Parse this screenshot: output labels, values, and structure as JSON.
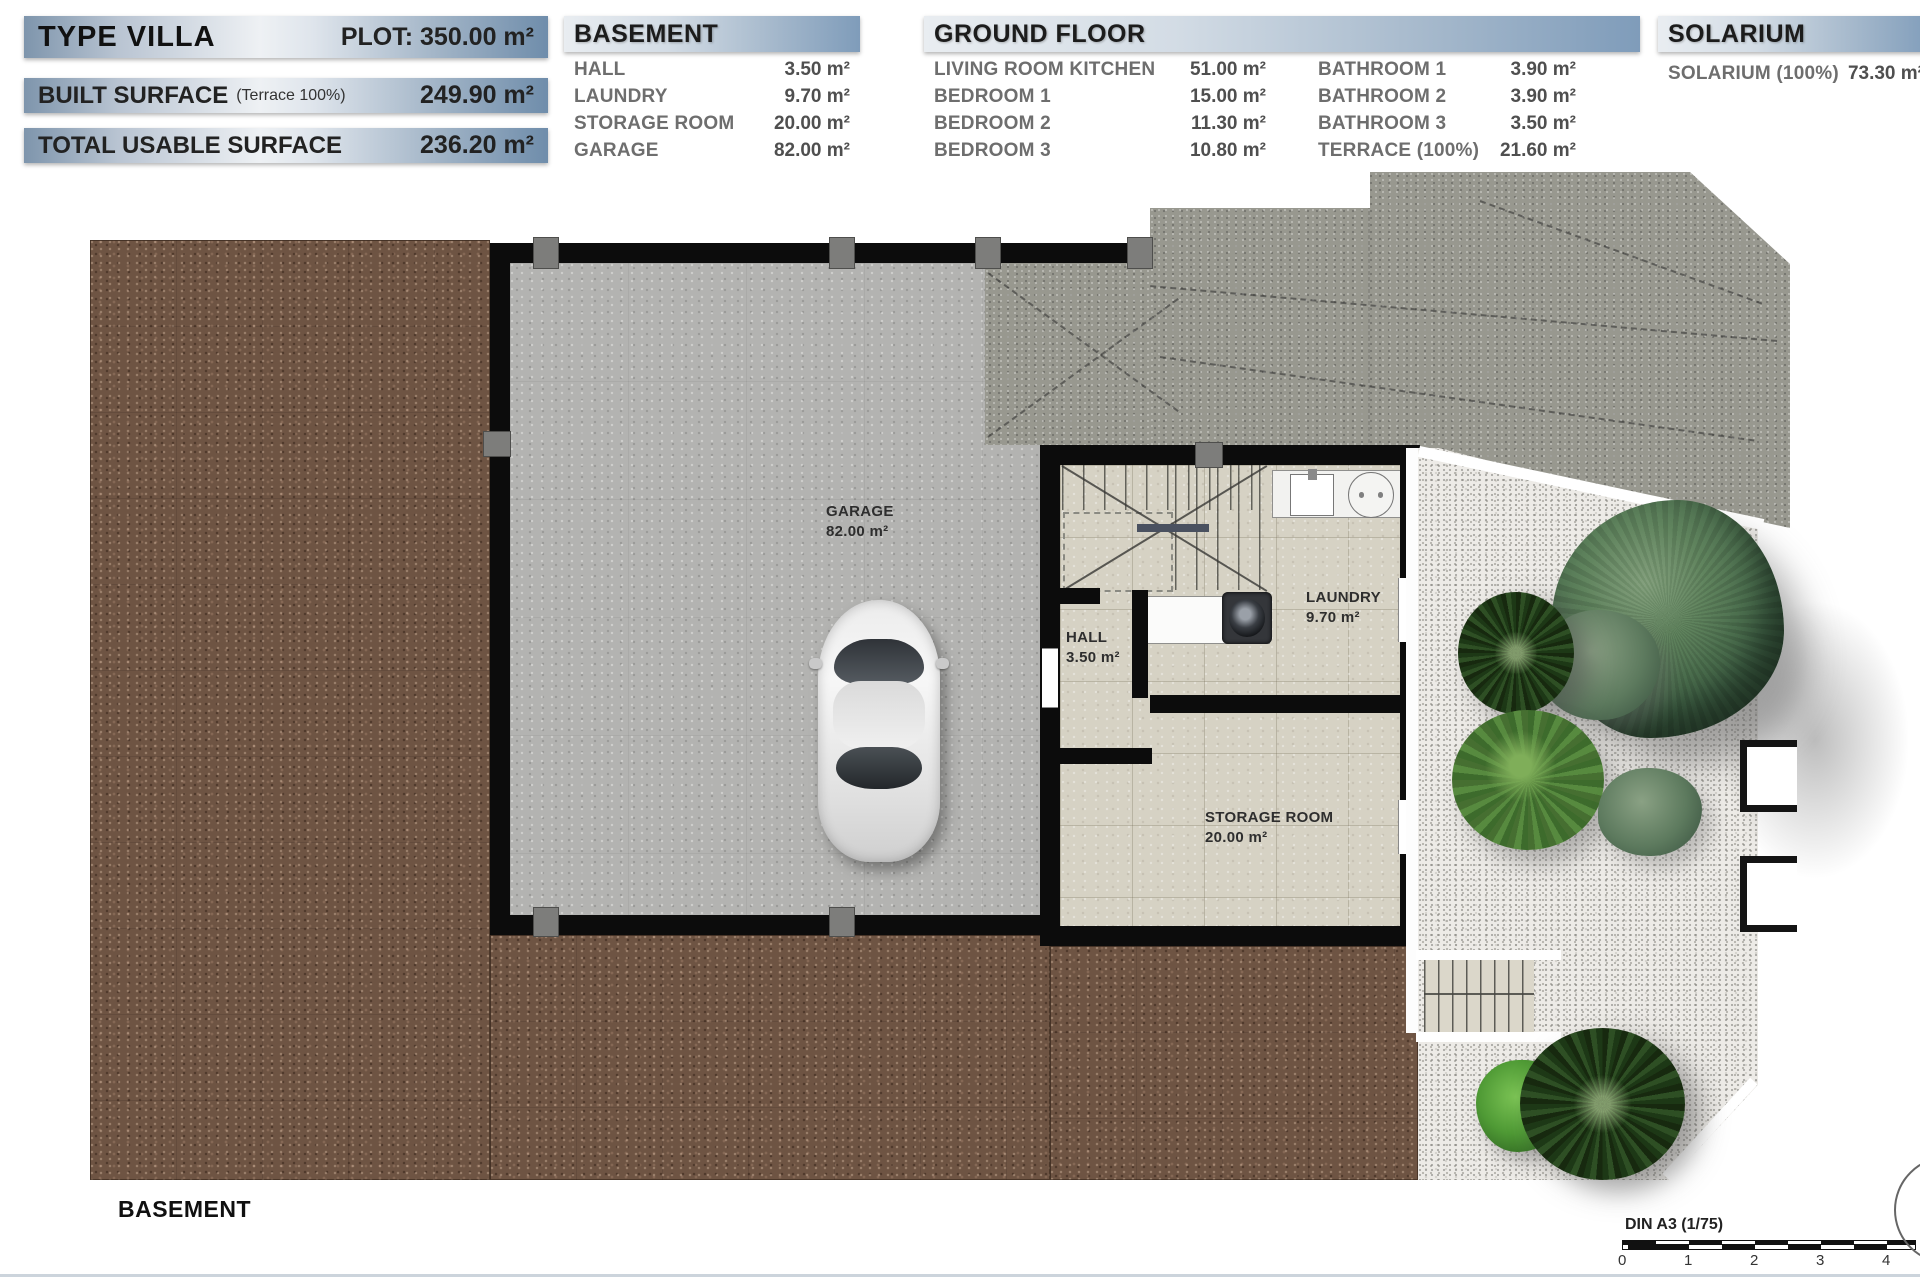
{
  "legend": {
    "type_villa": {
      "title": "TYPE VILLA",
      "plot": "PLOT: 350.00 m²"
    },
    "built_surface": {
      "label": "BUILT SURFACE",
      "note": "(Terrace 100%)",
      "value": "249.90 m²"
    },
    "total_usable_surface": {
      "label": "TOTAL USABLE SURFACE",
      "value": "236.20 m²"
    },
    "basement": {
      "title": "BASEMENT",
      "rows": [
        {
          "label": "HALL",
          "value": "3.50 m²"
        },
        {
          "label": "LAUNDRY",
          "value": "9.70 m²"
        },
        {
          "label": "STORAGE ROOM",
          "value": "20.00 m²"
        },
        {
          "label": "GARAGE",
          "value": "82.00 m²"
        }
      ]
    },
    "ground_floor": {
      "title": "GROUND FLOOR",
      "col1": [
        {
          "label": "LIVING ROOM KITCHEN",
          "value": "51.00 m²"
        },
        {
          "label": "BEDROOM 1",
          "value": "15.00 m²"
        },
        {
          "label": "BEDROOM 2",
          "value": "11.30 m²"
        },
        {
          "label": "BEDROOM 3",
          "value": "10.80 m²"
        }
      ],
      "col2": [
        {
          "label": "BATHROOM 1",
          "value": "3.90 m²"
        },
        {
          "label": "BATHROOM 2",
          "value": "3.90 m²"
        },
        {
          "label": "BATHROOM 3",
          "value": "3.50 m²"
        },
        {
          "label": "TERRACE (100%)",
          "value": "21.60 m²"
        }
      ]
    },
    "solarium": {
      "title": "SOLARIUM",
      "rows": [
        {
          "label": "SOLARIUM (100%)",
          "value": "73.30 m²"
        }
      ]
    }
  },
  "plan": {
    "rooms": [
      {
        "name": "GARAGE",
        "area": "82.00 m²"
      },
      {
        "name": "HALL",
        "area": "3.50 m²"
      },
      {
        "name": "LAUNDRY",
        "area": "9.70 m²"
      },
      {
        "name": "STORAGE ROOM",
        "area": "20.00 m²"
      }
    ],
    "floor_label": "BASEMENT"
  },
  "scalebar": {
    "label": "DIN A3 (1/75)",
    "ticks": [
      "0",
      "1",
      "2",
      "3",
      "4"
    ]
  },
  "colors": {
    "terrain": "#6e5443",
    "garage_floor": "#b3b3b1",
    "driveway": "#98988f",
    "tile": "#d6d2c4",
    "gravel": "#edebe7",
    "wall": "#0c0c0c",
    "header_blue": "#7f9cba"
  }
}
